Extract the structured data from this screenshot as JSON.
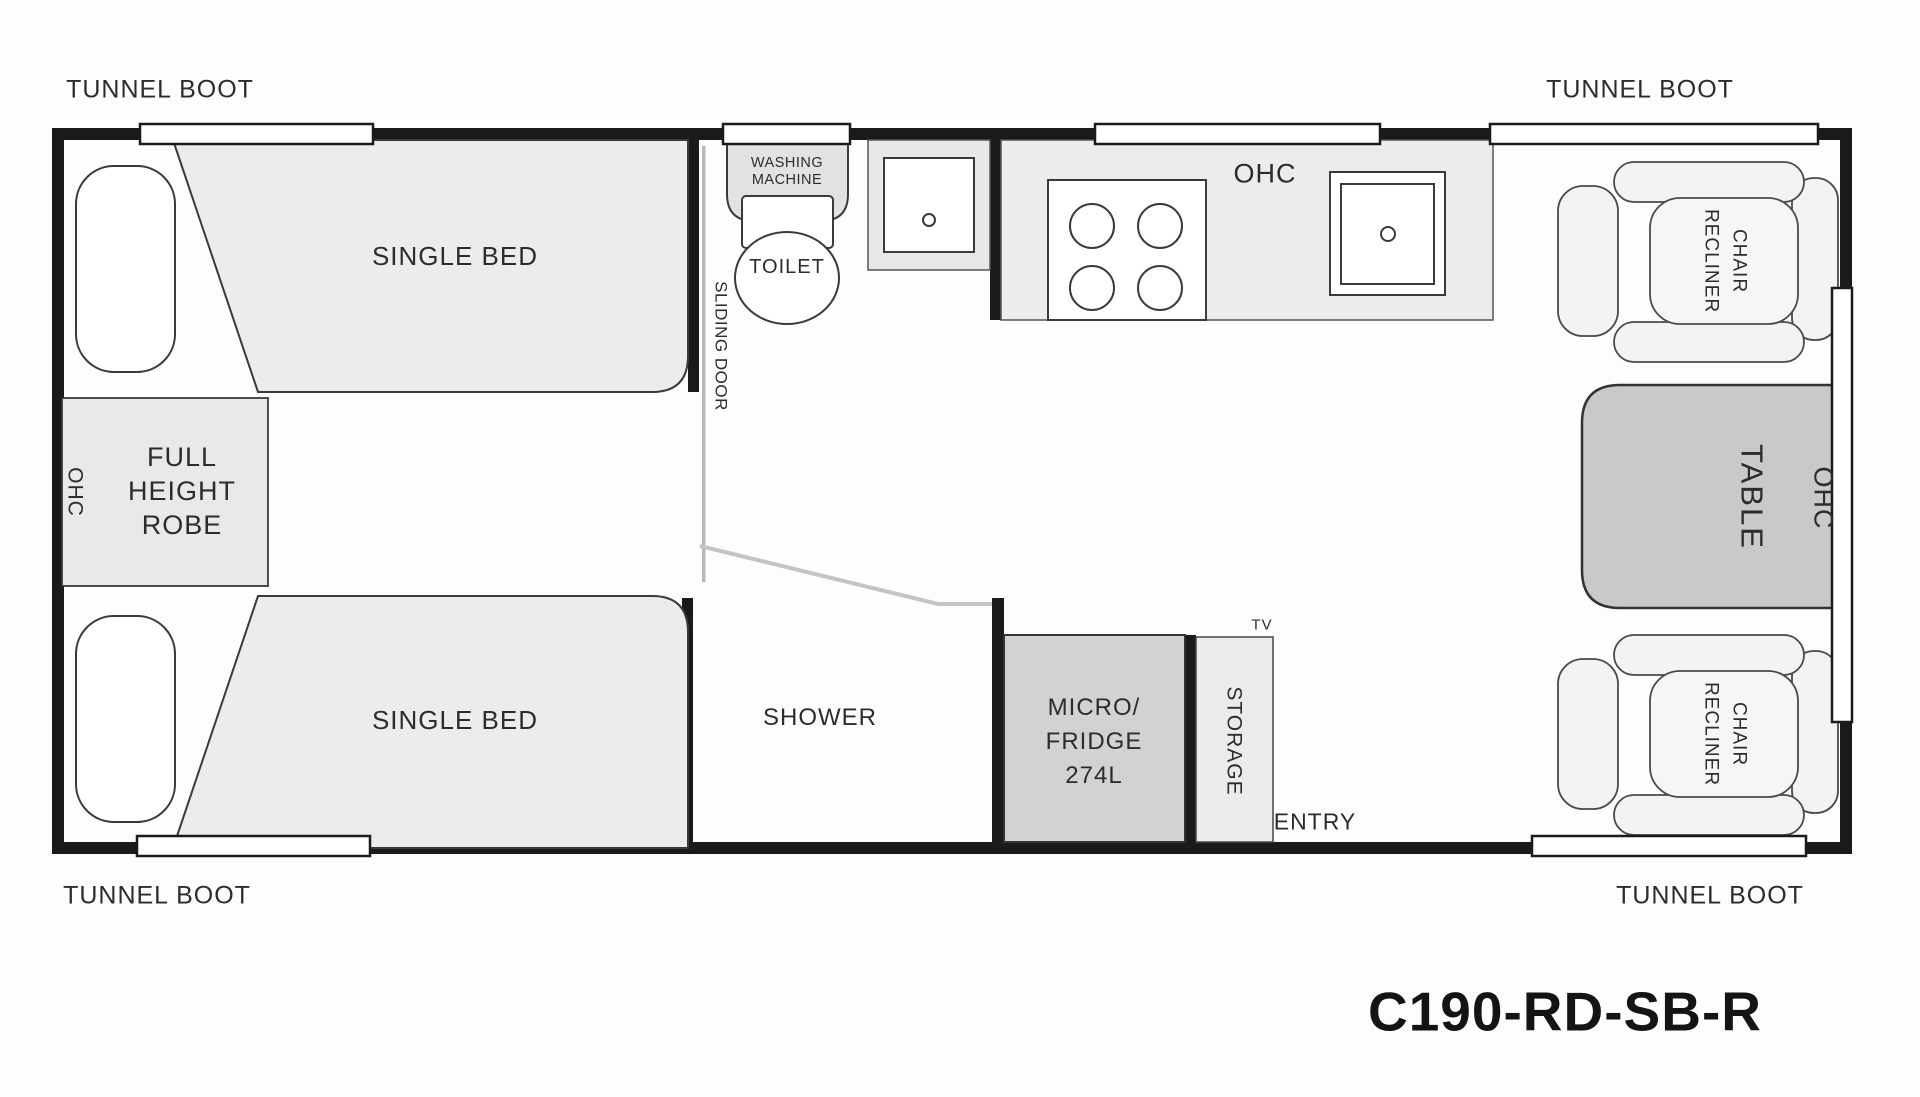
{
  "title": {
    "model_code": "C190-RD-SB-R"
  },
  "palette": {
    "wall": "#1a1a1a",
    "outline": "#3a3a3a",
    "floor": "#ffffff",
    "furniture_light_gray": "#ececec",
    "appliance_gray": "#d2d2d2",
    "table_gray": "#c9c9c9",
    "glass_gray": "#c4c4c4",
    "text": "#2c2c2c"
  },
  "exterior_labels": {
    "tunnel_boot_top_left": "TUNNEL BOOT",
    "tunnel_boot_top_right": "TUNNEL BOOT",
    "tunnel_boot_bottom_left": "TUNNEL BOOT",
    "tunnel_boot_bottom_right": "TUNNEL BOOT"
  },
  "bedroom": {
    "single_bed_top": "SINGLE BED",
    "single_bed_bottom": "SINGLE BED",
    "ohc": "OHC",
    "robe_line1": "FULL",
    "robe_line2": "HEIGHT",
    "robe_line3": "ROBE",
    "sliding_door": "SLIDING DOOR"
  },
  "bathroom": {
    "washing_machine_line1": "WASHING",
    "washing_machine_line2": "MACHINE",
    "toilet": "TOILET",
    "shower": "SHOWER"
  },
  "kitchen": {
    "ohc": "OHC",
    "micro_fridge_line1": "MICRO/",
    "micro_fridge_line2": "FRIDGE",
    "micro_fridge_line3": "274L",
    "storage": "STORAGE",
    "tv": "TV",
    "entry": "ENTRY"
  },
  "lounge": {
    "recliner_line1": "RECLINER",
    "recliner_line2": "CHAIR",
    "table": "TABLE",
    "ohc": "OHC"
  }
}
